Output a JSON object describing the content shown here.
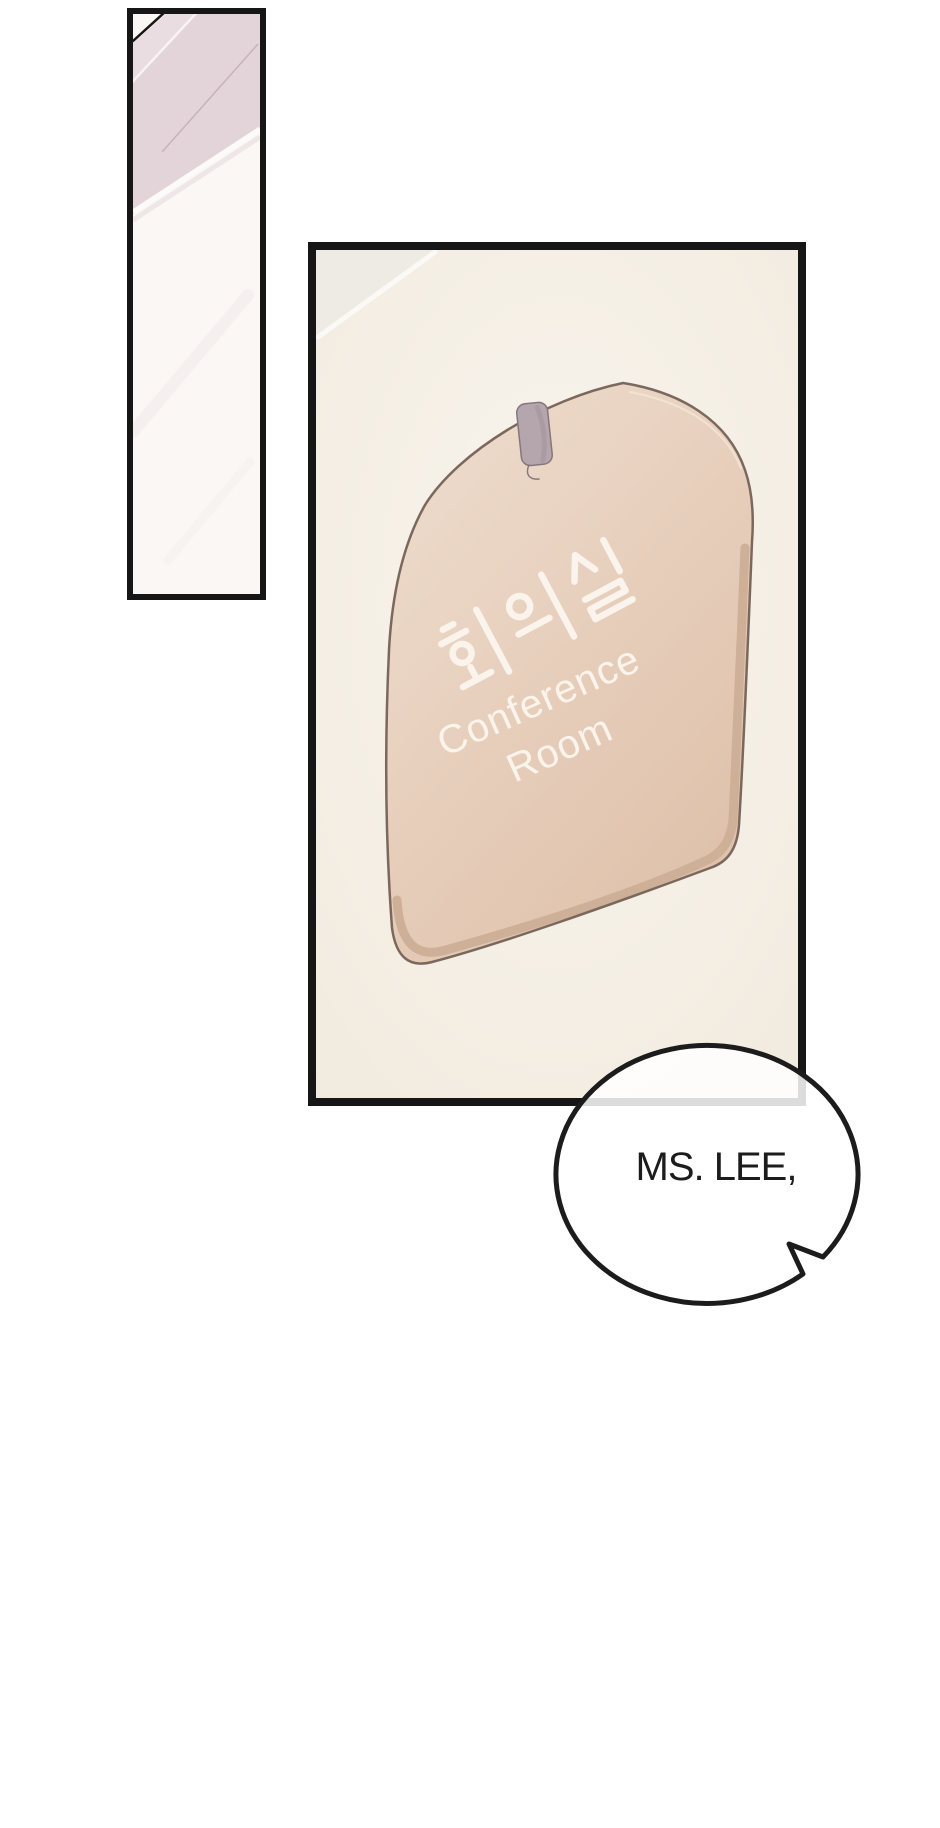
{
  "sign": {
    "korean_label": "회의실",
    "english_line1": "Conference",
    "english_line2": "Room"
  },
  "speech_bubble": {
    "text": "MS. LEE,"
  },
  "colors": {
    "page_bg": "#ffffff",
    "ink": "#161616",
    "text_ink": "#1c1c1c",
    "panel_cream": "#f9f5ee",
    "panel_cream_edge": "#f1eade",
    "corner_grey": "#eeeae4",
    "strip_bg": "#faf7f5",
    "pink_dark": "#e3d4d9",
    "pink_soft": "#e9dde1",
    "sign_light": "#eedccd",
    "sign_dark": "#debfa8",
    "sign_rim": "#ccae96",
    "sign_outline": "#7b685d",
    "sign_text": "#fbf4ec",
    "clip_grey": "#b5a6ad",
    "clip_outline": "#86757d",
    "bubble_fill": "#ffffff"
  }
}
